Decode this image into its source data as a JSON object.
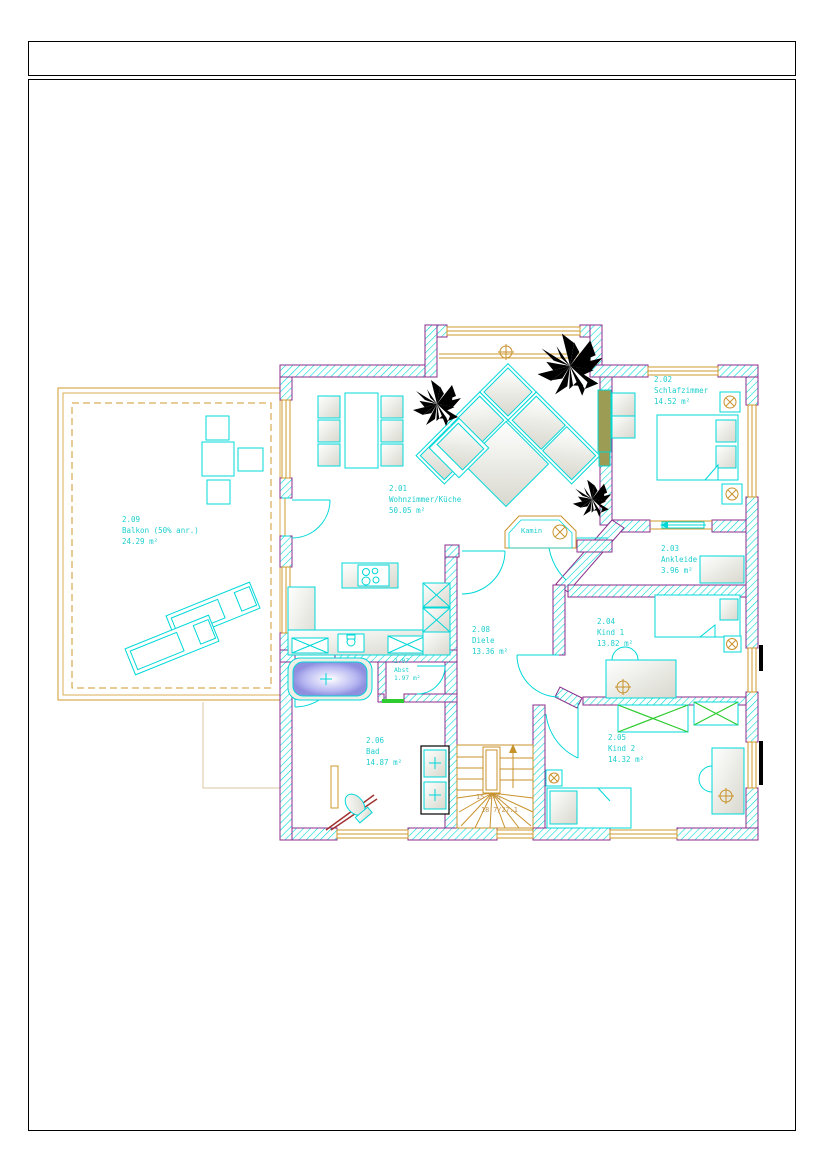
{
  "drawing": {
    "rooms": [
      {
        "number": "2.01",
        "name": "Wohnzimmer/Küche",
        "area": "50.05 m²"
      },
      {
        "number": "2.02",
        "name": "Schlafzimmer",
        "area": "14.52 m²"
      },
      {
        "number": "2.03",
        "name": "Ankleide",
        "area": "3.96 m²"
      },
      {
        "number": "2.04",
        "name": "Kind 1",
        "area": "13.82 m²"
      },
      {
        "number": "2.05",
        "name": "Kind 2",
        "area": "14.32 m²"
      },
      {
        "number": "2.06",
        "name": "Bad",
        "area": "14.87 m²"
      },
      {
        "number": "2.07",
        "name": "Abst",
        "area": "1.97 m²"
      },
      {
        "number": "2.08",
        "name": "Diele",
        "area": "13.36 m²"
      },
      {
        "number": "2.09",
        "name": "Balkon (50% anr.)",
        "area": "24.29 m²"
      }
    ],
    "annotations": {
      "fireplace": "Kamin",
      "stair_steps": "15 STG",
      "stair_dimensions": "18.7/27.1"
    },
    "colors": {
      "line_cyan": "#00d8d8",
      "text_cyan": "#1ecfcf",
      "wall_outline_purple": "#8b2e8b",
      "window_orange": "#d19a2b",
      "stair_tan": "#c09048",
      "wardrobe_green": "#2ecc2e",
      "shower_darkred": "#a03030",
      "plant_black": "#000000",
      "tub_violet": "#8f8fe0"
    }
  }
}
